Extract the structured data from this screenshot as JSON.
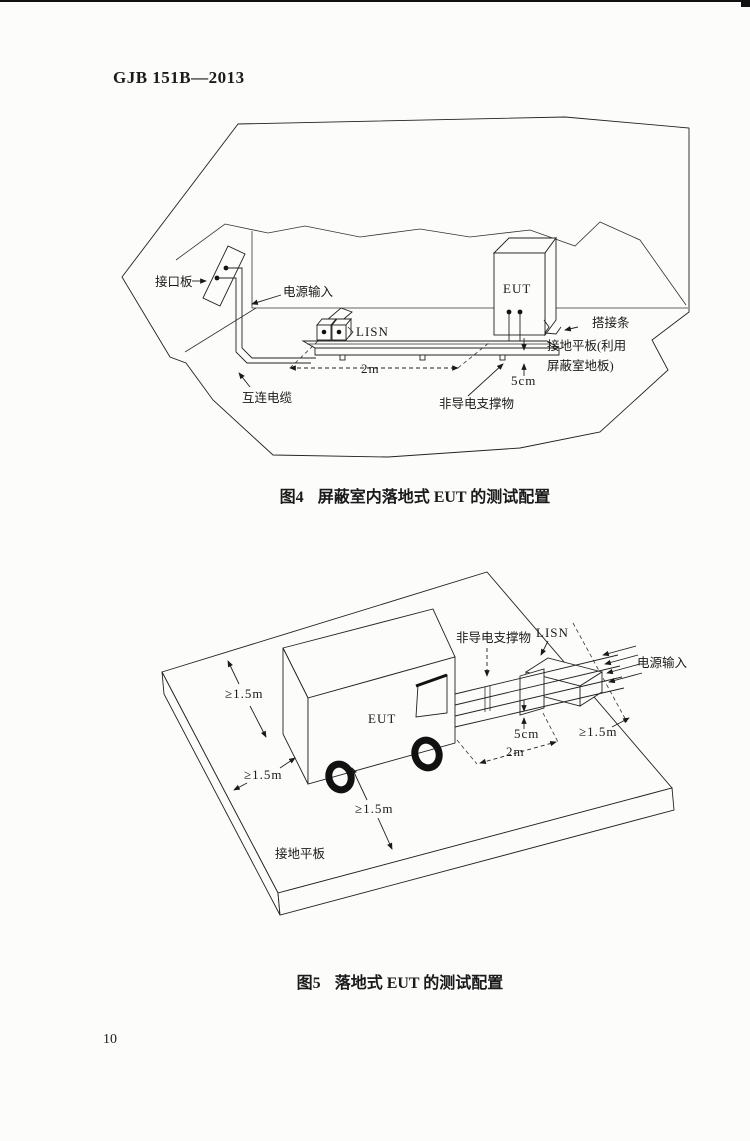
{
  "page": {
    "header": "GJB 151B—2013",
    "page_number": "10"
  },
  "fig4": {
    "caption_no": "图4",
    "caption_text": "屏蔽室内落地式 EUT 的测试配置",
    "labels": {
      "interface_panel": "接口板",
      "power_input": "电源输入",
      "lisn": "LISN",
      "eut": "EUT",
      "bonding_strap": "搭接条",
      "ground_plane_line1": "接地平板(利用",
      "ground_plane_line2": "屏蔽室地板)",
      "dim_5cm": "5cm",
      "dim_2m": "2m",
      "interconnect_cable": "互连电缆",
      "support": "非导电支撑物"
    }
  },
  "fig5": {
    "caption_no": "图5",
    "caption_text": "落地式 EUT 的测试配置",
    "labels": {
      "eut": "EUT",
      "support": "非导电支撑物",
      "lisn": "LISN",
      "power_input": "电源输入",
      "ground_plane": "接地平板",
      "dim_5cm": "5cm",
      "dim_2m": "2m",
      "dim_15_top": "≥1.5m",
      "dim_15_left": "≥1.5m",
      "dim_15_bottom": "≥1.5m",
      "dim_15_right": "≥1.5m"
    }
  }
}
